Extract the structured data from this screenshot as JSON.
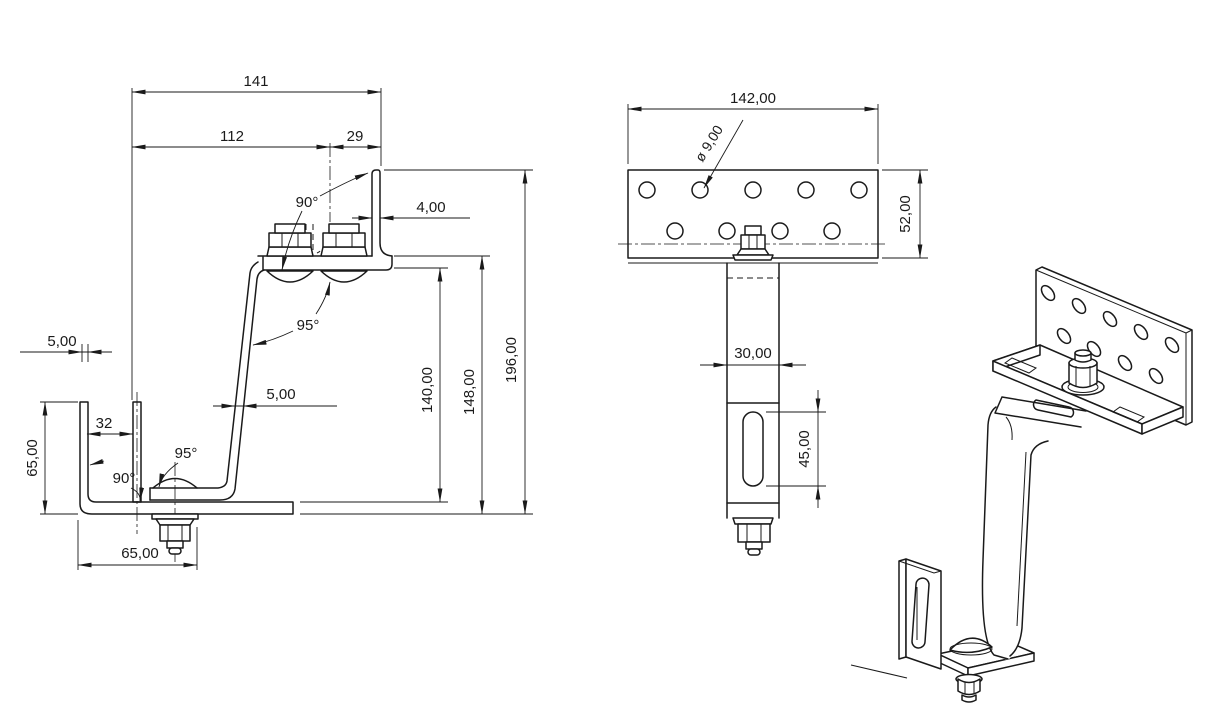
{
  "meta": {
    "description": "CAD technical drawing of a solar roof hook bracket, three views",
    "background_color": "#ffffff",
    "line_color": "#1a1a1a"
  },
  "front_view": {
    "name": "front view",
    "dimensions": {
      "total_width": "141",
      "left_width": "112",
      "right_width": "29",
      "top_angle": "90°",
      "flange_thickness": "4,00",
      "upper_bend_angle": "95°",
      "wall_thickness": "5,00",
      "arm_thickness": "5,00",
      "channel_inner_width": "32",
      "lower_bend_angle": "95°",
      "bottom_angle": "90°",
      "channel_height": "65,00",
      "base_width": "65,00",
      "inner_height": "140,00",
      "mid_height": "148,00",
      "total_height": "196,00"
    }
  },
  "top_view": {
    "name": "plate and bar view",
    "dimensions": {
      "plate_width": "142,00",
      "hole_diameter": "ø 9,00",
      "plate_height": "52,00",
      "bar_width": "30,00",
      "slot_length": "45,00"
    }
  },
  "isometric_view": {
    "name": "isometric view"
  }
}
